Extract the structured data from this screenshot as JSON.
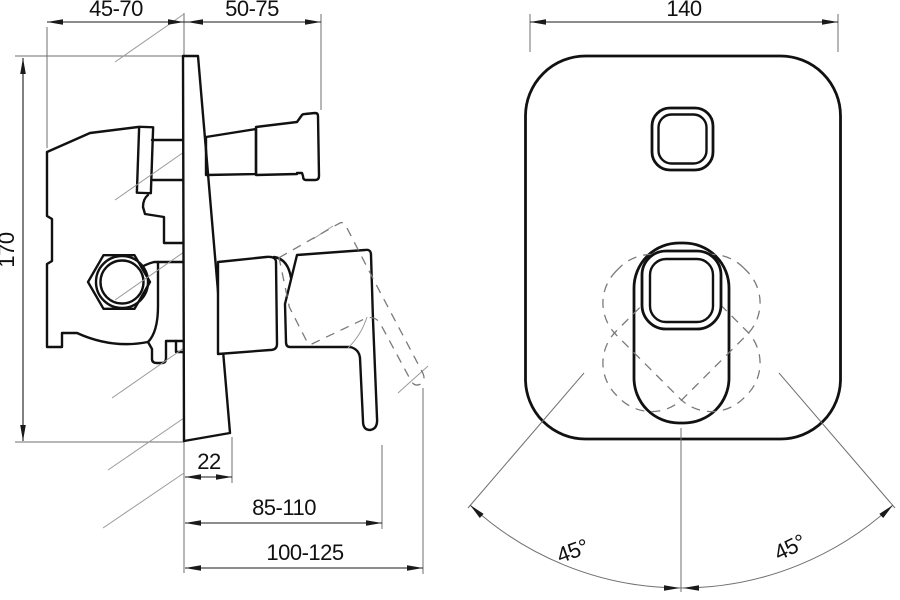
{
  "drawing": {
    "side_view": {
      "wall_depth_range": "45-70",
      "outlet_projection_range": "50-75",
      "body_height": "170",
      "plate_bottom_offset": "22",
      "lever_reach_down": "85-110",
      "lever_reach_up": "100-125"
    },
    "front_view": {
      "plate_width": "140",
      "swing_left": "45°",
      "swing_right": "45°"
    }
  }
}
